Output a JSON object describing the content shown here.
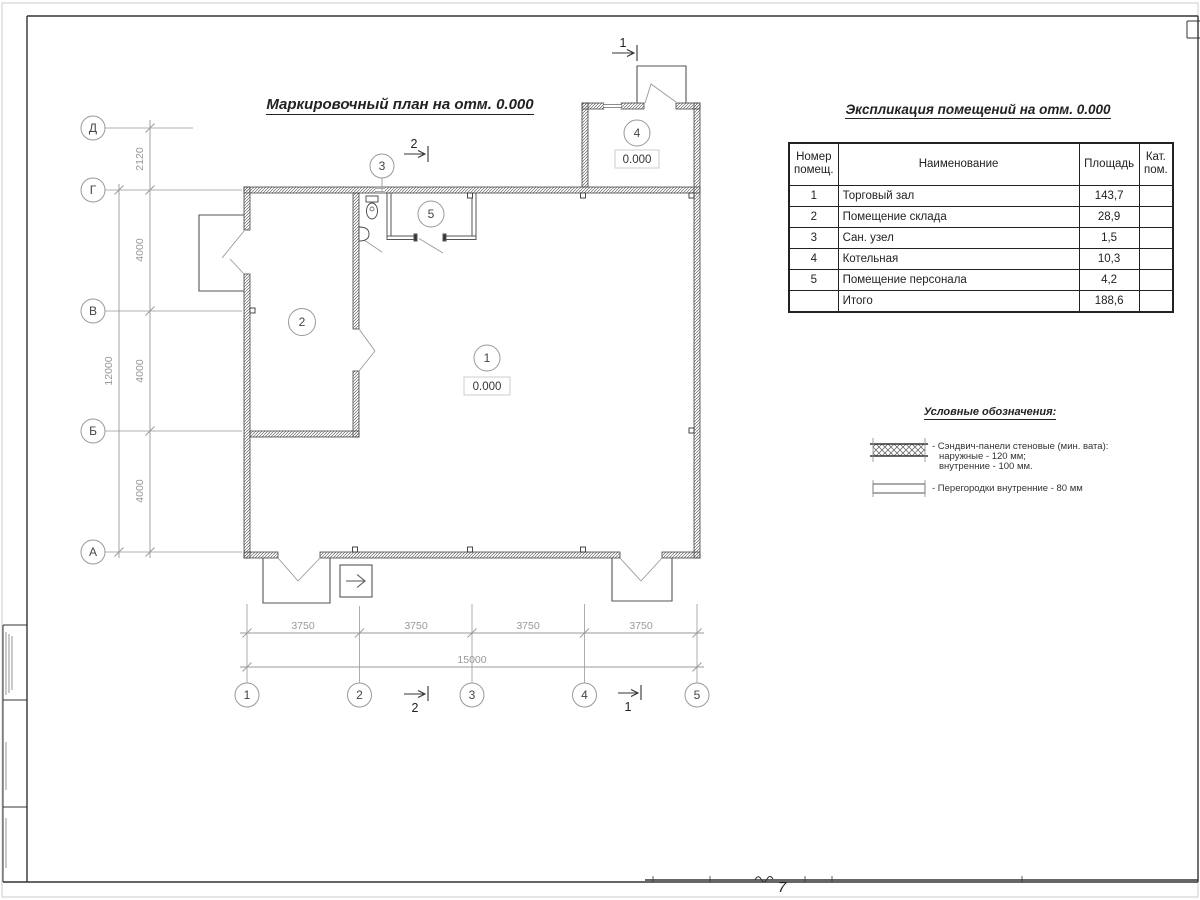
{
  "frame": {
    "sheet_note": "7"
  },
  "plan": {
    "title": "Маркировочный план на отм. 0.000",
    "axes_rows": [
      "Д",
      "Г",
      "В",
      "Б",
      "А"
    ],
    "axes_cols": [
      "1",
      "2",
      "3",
      "4",
      "5"
    ],
    "dims_left": [
      "2120",
      "4000",
      "4000",
      "4000"
    ],
    "dim_left_total": "12000",
    "dims_bottom": [
      "3750",
      "3750",
      "3750",
      "3750"
    ],
    "dim_bottom_total": "15000",
    "rooms": [
      {
        "num": "1",
        "elev": "0.000"
      },
      {
        "num": "2"
      },
      {
        "num": "3"
      },
      {
        "num": "4",
        "elev": "0.000"
      },
      {
        "num": "5"
      }
    ],
    "sections": {
      "top_right": "1",
      "top_mid": "2",
      "bottom_mid": "2",
      "bottom_right": "1"
    }
  },
  "table": {
    "title": "Экспликация помещений на отм. 0.000",
    "headers": {
      "num": "Номер помещ.",
      "name": "Наименование",
      "area": "Площадь",
      "cat": "Кат. пом."
    },
    "rows": [
      {
        "num": "1",
        "name": "Торговый зал",
        "area": "143,7",
        "cat": ""
      },
      {
        "num": "2",
        "name": "Помещение склада",
        "area": "28,9",
        "cat": ""
      },
      {
        "num": "3",
        "name": "Сан. узел",
        "area": "1,5",
        "cat": ""
      },
      {
        "num": "4",
        "name": "Котельная",
        "area": "10,3",
        "cat": ""
      },
      {
        "num": "5",
        "name": "Помещение персонала",
        "area": "4,2",
        "cat": ""
      }
    ],
    "total": {
      "label": "Итого",
      "area": "188,6"
    }
  },
  "legend": {
    "title": "Условные обозначения:",
    "item1_line1": "- Сэндвич-панели стеновые (мин. вата):",
    "item1_line2": "наружные - 120 мм;",
    "item1_line3": "внутренние - 100 мм.",
    "item2_line1": "- Перегородки внутренние - 80 мм"
  }
}
